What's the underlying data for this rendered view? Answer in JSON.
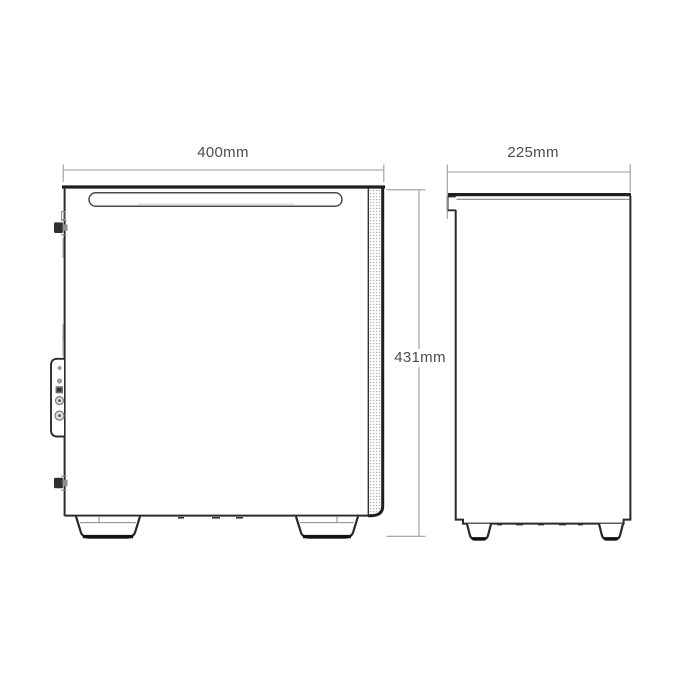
{
  "diagram": {
    "dimensions": {
      "width": "400mm",
      "depth": "225mm",
      "height": "431mm"
    },
    "colors": {
      "outline": "#1f1f1f",
      "secondary_line": "#555555",
      "faint_line": "#8a8a8a",
      "dimension_line": "#9b9b9b",
      "label_text": "#4d4d4d",
      "mesh_dot": "#b5b5b5",
      "background": "#ffffff"
    }
  }
}
